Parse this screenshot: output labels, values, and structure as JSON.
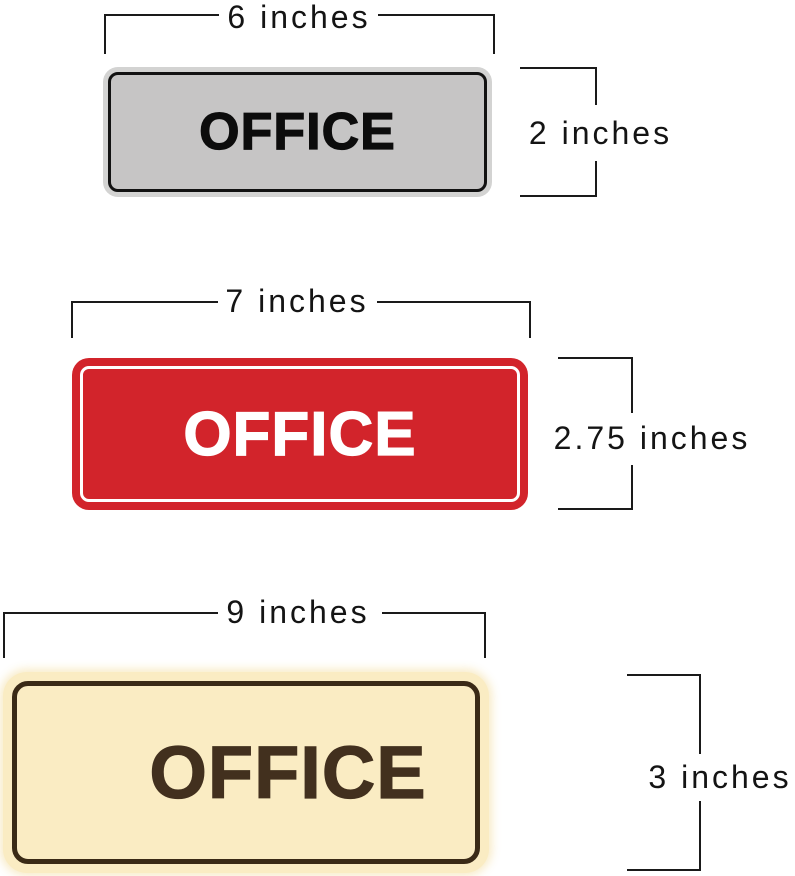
{
  "page": {
    "background": "#ffffff",
    "line_color": "#1a1a1a",
    "label_color": "#141414"
  },
  "signs": [
    {
      "id": "small-gray-sign",
      "text": "OFFICE",
      "width_label": "6 inches",
      "height_label": "2 inches",
      "colors": {
        "rim": "#d3d3d2",
        "border": "#121212",
        "fill": "#c6c5c5",
        "text": "#0c0c0c"
      }
    },
    {
      "id": "medium-red-sign",
      "text": "OFFICE",
      "width_label": "7 inches",
      "height_label": "2.75 inches",
      "colors": {
        "fill": "#d2242b",
        "outline": "#ffffff",
        "text": "#ffffff"
      }
    },
    {
      "id": "large-cream-sign",
      "text": "OFFICE",
      "width_label": "9 inches",
      "height_label": "3 inches",
      "colors": {
        "fill": "#faecc3",
        "border": "#3a2a16",
        "text": "#42301e",
        "glow": "#f7e9c1"
      }
    }
  ]
}
